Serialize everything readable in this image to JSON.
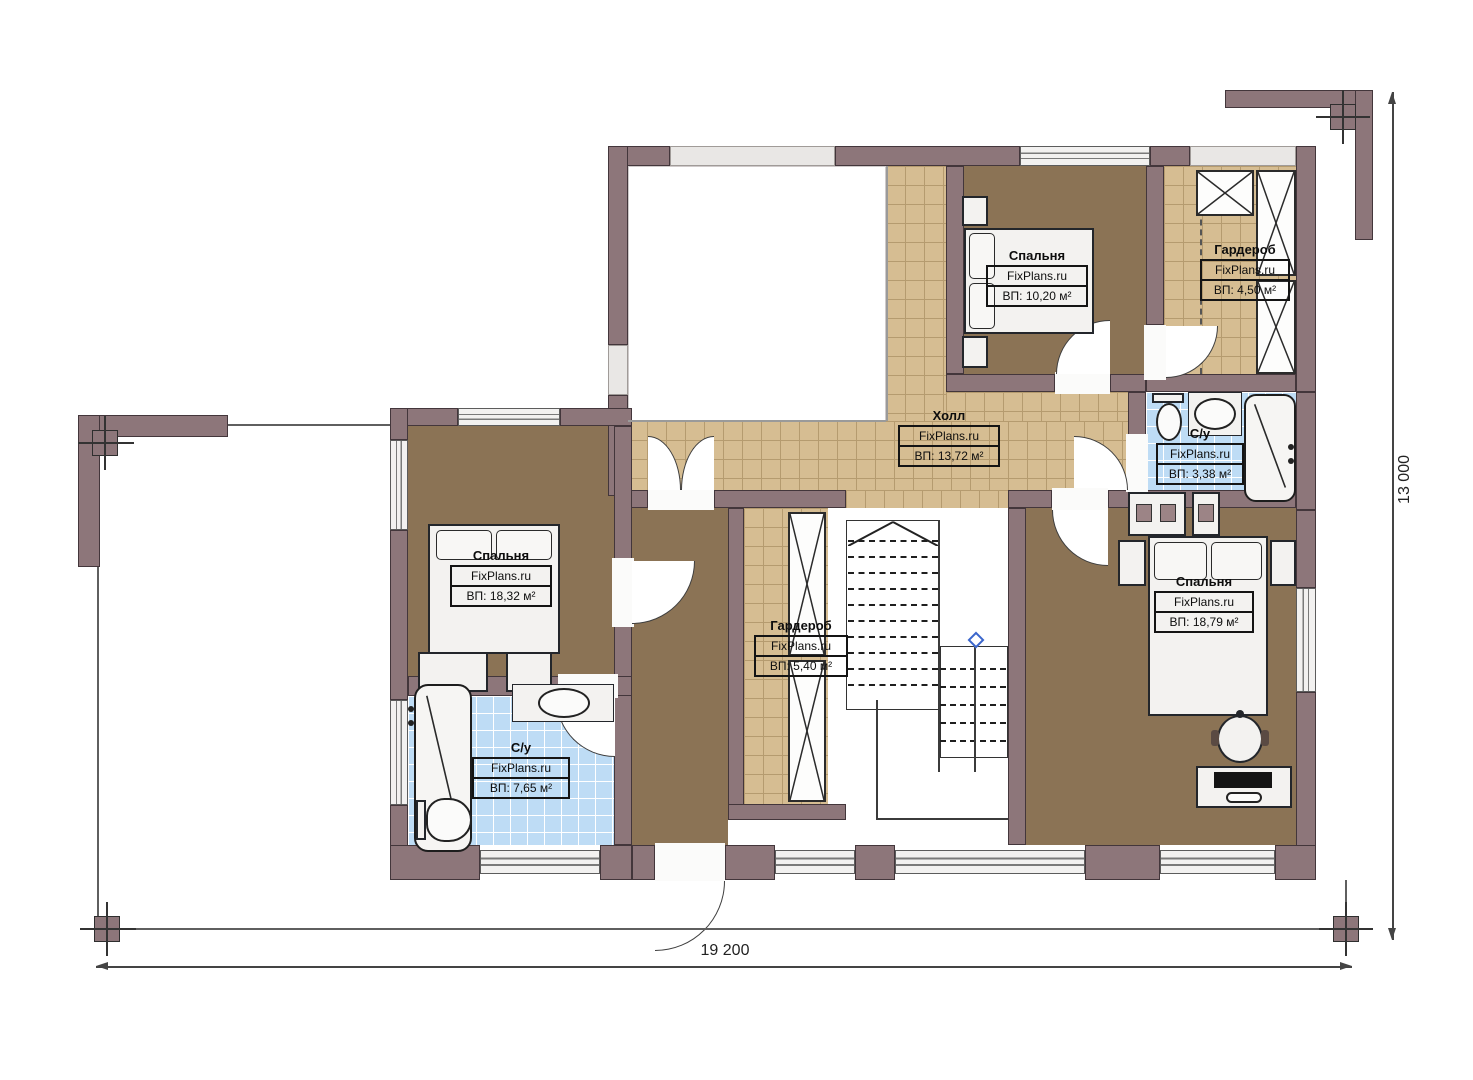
{
  "plan": {
    "watermark": "FixPlans.ru",
    "dimensions": {
      "width_label": "19 200",
      "height_label": "13 000"
    },
    "rooms": [
      {
        "key": "bedroom-top",
        "name": "Спальня",
        "area": "ВП: 10,20 м²"
      },
      {
        "key": "wardrobe-top",
        "name": "Гардероб",
        "area": "ВП: 4,50 м²"
      },
      {
        "key": "hall",
        "name": "Холл",
        "area": "ВП: 13,72 м²"
      },
      {
        "key": "bathroom-right",
        "name": "С/у",
        "area": "ВП: 3,38 м²"
      },
      {
        "key": "bedroom-left",
        "name": "Спальня",
        "area": "ВП: 18,32 м²"
      },
      {
        "key": "wardrobe-center",
        "name": "Гардероб",
        "area": "ВП: 5,40 м²"
      },
      {
        "key": "bedroom-right",
        "name": "Спальня",
        "area": "ВП: 18,79 м²"
      },
      {
        "key": "bathroom-left",
        "name": "С/у",
        "area": "ВП: 7,65 м²"
      }
    ],
    "stairs": {
      "flight_a_steps": 12,
      "flight_b_steps": 6
    },
    "colors": {
      "wall": "#8d767a",
      "floor_wood": "#8b7355",
      "tile_beige": "#d6bd92",
      "tile_blue": "#bedcf5",
      "marker_blue": "#3b66cc"
    }
  }
}
